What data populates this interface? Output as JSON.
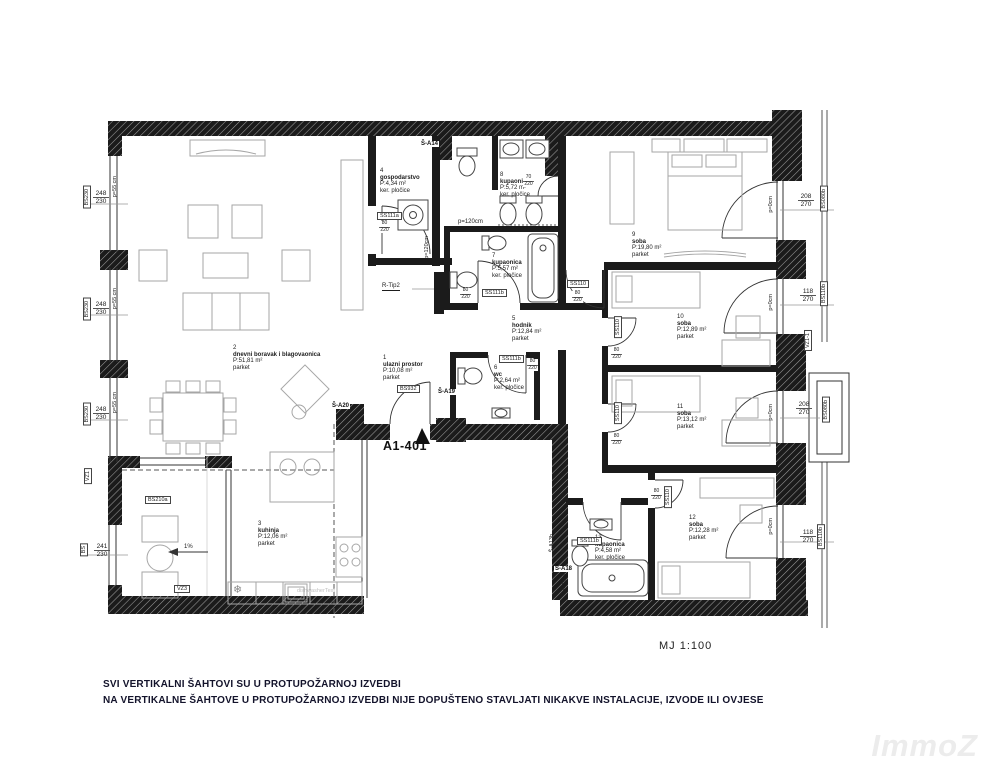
{
  "plan": {
    "apartment_id": "A1-401",
    "scale_label": "MJ  1:100",
    "watermark": "ImmoZ",
    "notes": [
      "SVI VERTIKALNI ŠAHTOVI SU U PROTUPOŽARNOJ IZVEDBI",
      "NA VERTIKALNE ŠAHTOVE U PROTUPOŽARNOJ IZVEDBI NIJE DOPUŠTENO STAVLJATI NIKAKVE INSTALACIJE, IZVODE ILI OVJESE"
    ]
  },
  "rooms": [
    {
      "num": "1",
      "name": "ulazni prostor",
      "area": "P:10,08 m²",
      "floor": "parket"
    },
    {
      "num": "2",
      "name": "dnevni boravak i blagovaonica",
      "area": "P:51,81 m²",
      "floor": "parket"
    },
    {
      "num": "3",
      "name": "kuhinja",
      "area": "P:12,06 m²",
      "floor": "parket"
    },
    {
      "num": "4",
      "name": "gospodarstvo",
      "area": "P:4,34 m²",
      "floor": "ker. pločice"
    },
    {
      "num": "5",
      "name": "hodnik",
      "area": "P:12,84 m²",
      "floor": "parket"
    },
    {
      "num": "6",
      "name": "wc",
      "area": "P:2,64 m²",
      "floor": "ker. pločice"
    },
    {
      "num": "7",
      "name": "kupaonica",
      "area": "P:5,57 m²",
      "floor": "ker. pločice"
    },
    {
      "num": "8",
      "name": "kupaonica",
      "area": "P:5,72 m²",
      "floor": "ker. pločice"
    },
    {
      "num": "9",
      "name": "soba",
      "area": "P:19,80 m²",
      "floor": "parket"
    },
    {
      "num": "10",
      "name": "soba",
      "area": "P:12,89 m²",
      "floor": "parket"
    },
    {
      "num": "11",
      "name": "soba",
      "area": "P:13,12 m²",
      "floor": "parket"
    },
    {
      "num": "12",
      "name": "soba",
      "area": "P:12,28 m²",
      "floor": "parket"
    },
    {
      "num": "13",
      "name": "kupaonica",
      "area": "P:4,58 m²",
      "floor": "ker. pločice"
    }
  ],
  "dims": {
    "window_left_w": "248",
    "window_left_h": "230",
    "window_kitchen_w": "241",
    "window_kitchen_h": "230",
    "balcony_large_w": "208",
    "balcony_large_h": "270",
    "balcony_small_w": "118",
    "balcony_small_h": "270",
    "door_std_w": "80",
    "door_std_h": "220",
    "door_narrow_w": "70",
    "door_narrow_h": "220",
    "parapet_55": "p=55 cm",
    "parapet_120": "p=120cm",
    "parapet_60": "p=60cm",
    "parapet_0": "p=0cm",
    "slope": "1%"
  },
  "codes": {
    "window_left": "BS230",
    "terrace_door": "BS210a",
    "entry_door": "BS932",
    "door_a": "SS111a",
    "door_b": "SS111b",
    "door_c": "SS110",
    "vz1": "VZ1",
    "vz3": "VZ3",
    "vz1_1": "VZ1-1",
    "bs_small": "BS",
    "balcony_code_large": "BS080b",
    "balcony_code_small": "BS110b",
    "radiator": "R-Tip2",
    "shaft_14": "Š-A14",
    "shaft_18": "Š-A18",
    "shaft_19": "Š-A19",
    "shaft_20": "Š-A20",
    "shaft_13": "Š-A13b",
    "dishwasher_text": "dishwasherText",
    "fridge_symbol": "❄"
  }
}
